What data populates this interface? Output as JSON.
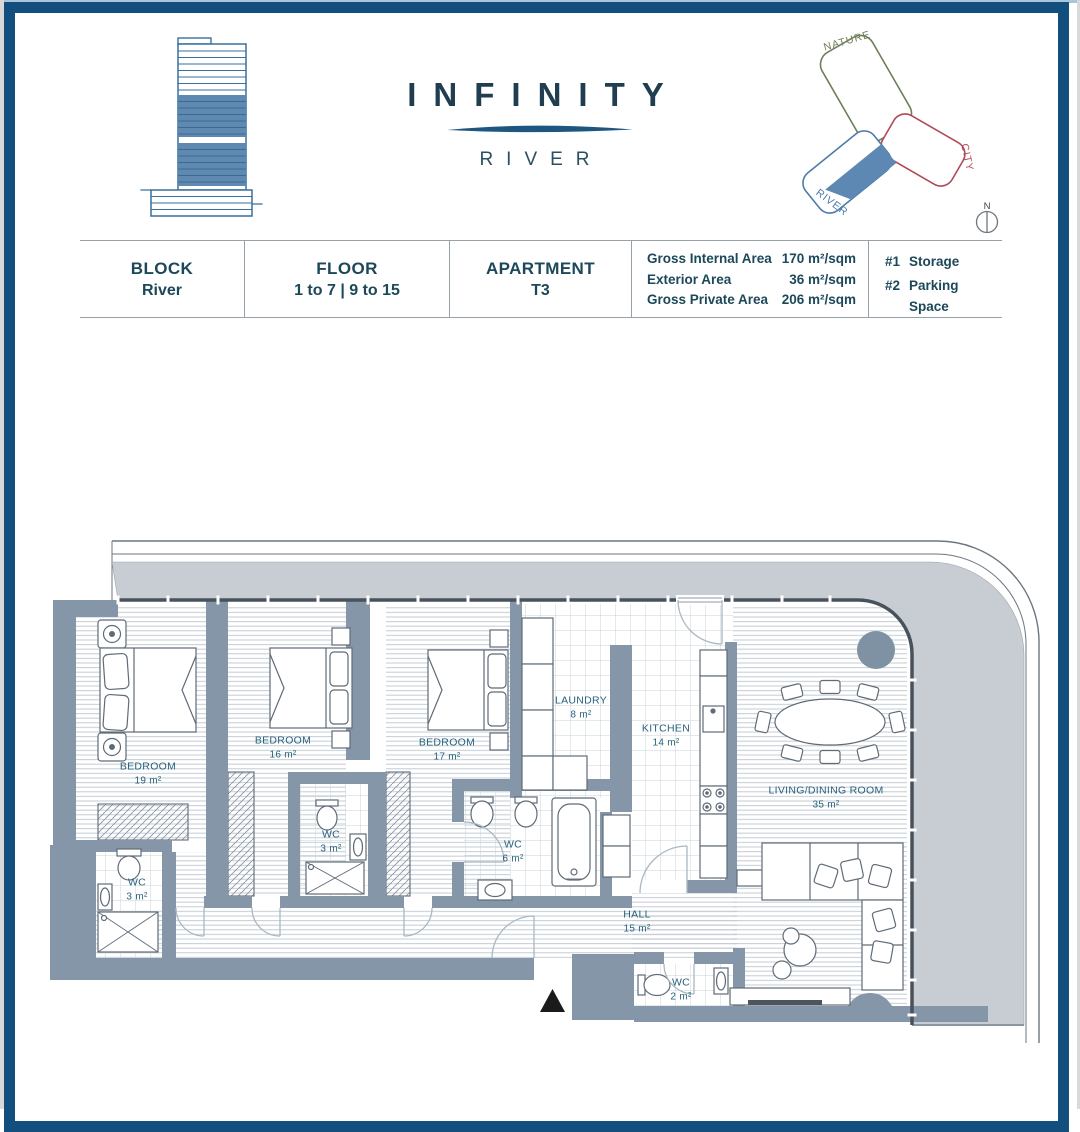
{
  "brand": {
    "title": "INFINITY",
    "subtitle": "RIVER"
  },
  "site_plan": {
    "nature": "NATURE",
    "city": "CITY",
    "river": "RIVER",
    "compass": "N"
  },
  "info": {
    "block_label": "BLOCK",
    "block_value": "River",
    "floor_label": "FLOOR",
    "floor_value": "1 to 7 | 9 to 15",
    "apartment_label": "APARTMENT",
    "apartment_value": "T3",
    "areas": [
      {
        "label": "Gross Internal Area",
        "value": "170 m²/sqm"
      },
      {
        "label": "Exterior Area",
        "value": "36 m²/sqm"
      },
      {
        "label": "Gross Private Area",
        "value": "206 m²/sqm"
      }
    ],
    "extras": [
      {
        "label": "#1",
        "value": "Storage"
      },
      {
        "label": "#2",
        "value": "Parking Space"
      }
    ]
  },
  "plan": {
    "rooms": [
      {
        "name": "BEDROOM",
        "area": "19 m²"
      },
      {
        "name": "BEDROOM",
        "area": "16 m²"
      },
      {
        "name": "BEDROOM",
        "area": "17 m²"
      },
      {
        "name": "LAUNDRY",
        "area": "8 m²"
      },
      {
        "name": "KITCHEN",
        "area": "14 m²"
      },
      {
        "name": "LIVING/DINING ROOM",
        "area": "35 m²"
      },
      {
        "name": "WC",
        "area": "3 m²"
      },
      {
        "name": "WC",
        "area": "3 m²"
      },
      {
        "name": "WC",
        "area": "6 m²"
      },
      {
        "name": "HALL",
        "area": "15 m²"
      },
      {
        "name": "WC",
        "area": "2 m²"
      }
    ]
  },
  "colors": {
    "accent_navy": "#134f7e",
    "wall": "#8496a7",
    "terrace": "#c8cdd4",
    "label": "#27617c",
    "brand_dark": "#203e4f",
    "nature": "#6e8059",
    "city": "#b04a57",
    "river": "#4d7ca8",
    "river_fill": "#5c88b3"
  }
}
